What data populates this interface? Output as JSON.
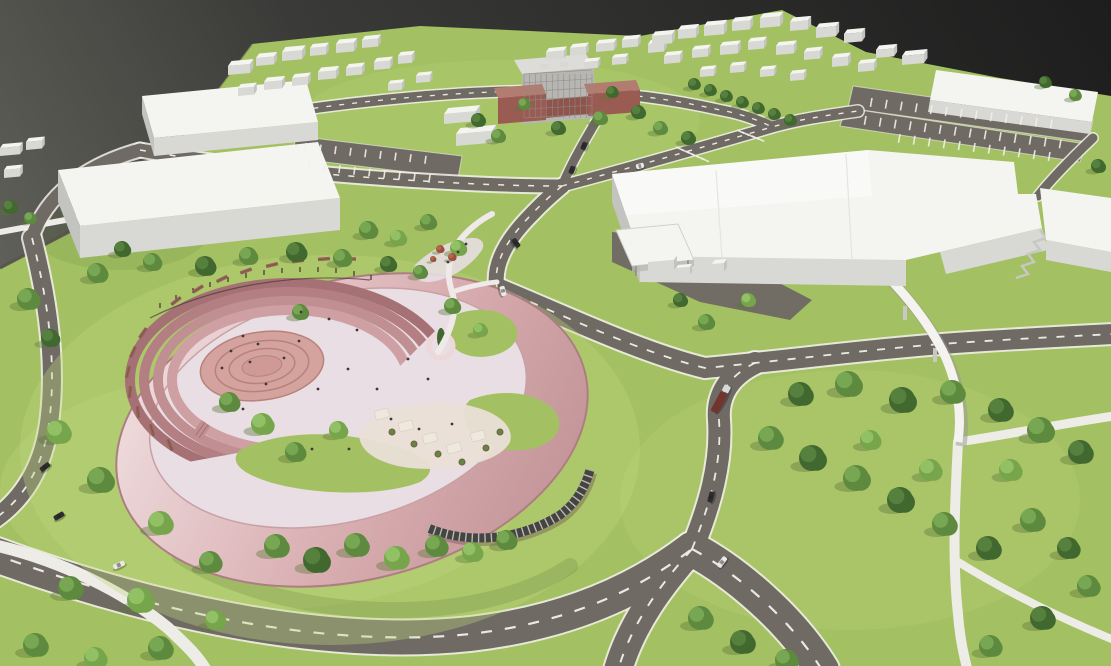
{
  "scene_label": "aerial-3d-masterplan-render",
  "palette": {
    "backdrop_top": "#1d1d1d",
    "backdrop_mid": "#3a3a38",
    "backdrop_low": "#75756c",
    "grass": "#a3c162",
    "grass_light": "#c0d77f",
    "grass_dark": "#86a84e",
    "shadow_green": "#5d763a",
    "road": "#6f6a64",
    "marking": "#f2f0ea",
    "path": "#edece6",
    "bridge": "#f4f3ef",
    "bridge_shadow": "#9a9993",
    "bld_top": "#f4f4f1",
    "bld_top2": "#fbfbf9",
    "bld_front": "#d8d8d4",
    "bld_side": "#c3c3bf",
    "brick": "#9a5c52",
    "brick_top": "#b27c70",
    "brick_dark": "#8f544b",
    "midrise_face": "#b8b6b2",
    "midrise_top": "#dcdcd8",
    "window": "#8e8c88",
    "rose_light": "#ecd7d9",
    "rose": "#d9aeb1",
    "rose_deep": "#c4969a",
    "rose_edge": "#ad7e81",
    "terrace1": "#cfa0a3",
    "terrace2": "#c08f92",
    "terrace3": "#b37f83",
    "terrace4": "#a67174",
    "plaza": "#d5a39e",
    "plaza_ring": "#b8817c",
    "plaza_core": "#cf9a95",
    "paving": "#e8dee3",
    "paving_warm": "#eadfd6",
    "glass": "#454442",
    "mullion": "#cfcfcb",
    "bench": "#96655a",
    "post": "#4a3a36",
    "tree_dark": "#41682f",
    "tree_dark_hi": "#5a8540",
    "tree_mid": "#5d8a3e",
    "tree_mid_hi": "#7cab57",
    "tree_light": "#76a54b",
    "tree_light_hi": "#97c46a",
    "shrub": "#9c4f3d",
    "shrub_hi": "#bc6a4e",
    "car_dark": "#2e2e30",
    "car_gray": "#55565a",
    "car_white": "#e8e8e6",
    "truck_body": "#70352f",
    "truck_cab": "#d8d8d6",
    "people": "#3a3a3c",
    "canopy_shade": "#efe9dd",
    "planter_rim": "#7a5c49"
  },
  "scene": {
    "trees": [
      [
        28,
        299,
        11,
        "m"
      ],
      [
        50,
        338,
        9,
        "d"
      ],
      [
        10,
        207,
        7,
        "d"
      ],
      [
        30,
        218,
        6,
        "m"
      ],
      [
        97,
        273,
        10,
        "m"
      ],
      [
        122,
        249,
        8,
        "d"
      ],
      [
        152,
        262,
        9,
        "m"
      ],
      [
        205,
        266,
        10,
        "d"
      ],
      [
        248,
        256,
        9,
        "m"
      ],
      [
        296,
        252,
        10,
        "d"
      ],
      [
        342,
        258,
        9,
        "m"
      ],
      [
        388,
        264,
        8,
        "d"
      ],
      [
        58,
        432,
        12,
        "l"
      ],
      [
        100,
        480,
        13,
        "m"
      ],
      [
        160,
        523,
        12,
        "l"
      ],
      [
        210,
        562,
        11,
        "m"
      ],
      [
        140,
        600,
        13,
        "l"
      ],
      [
        70,
        588,
        12,
        "m"
      ],
      [
        35,
        645,
        12,
        "m"
      ],
      [
        95,
        658,
        11,
        "l"
      ],
      [
        160,
        648,
        12,
        "m"
      ],
      [
        215,
        620,
        10,
        "l"
      ],
      [
        229,
        402,
        10,
        "m"
      ],
      [
        262,
        424,
        11,
        "l"
      ],
      [
        295,
        452,
        10,
        "m"
      ],
      [
        338,
        430,
        9,
        "l"
      ],
      [
        300,
        312,
        8,
        "m"
      ],
      [
        452,
        306,
        8,
        "m"
      ],
      [
        480,
        330,
        7,
        "l"
      ],
      [
        276,
        546,
        12,
        "m"
      ],
      [
        316,
        560,
        13,
        "d"
      ],
      [
        356,
        545,
        12,
        "m"
      ],
      [
        396,
        558,
        12,
        "l"
      ],
      [
        436,
        546,
        11,
        "m"
      ],
      [
        472,
        552,
        10,
        "l"
      ],
      [
        506,
        540,
        10,
        "m"
      ],
      [
        368,
        230,
        9,
        "m"
      ],
      [
        398,
        238,
        8,
        "l"
      ],
      [
        428,
        222,
        8,
        "m"
      ],
      [
        458,
        248,
        8,
        "l"
      ],
      [
        420,
        272,
        7,
        "m"
      ],
      [
        440,
        249,
        4,
        "r"
      ],
      [
        452,
        257,
        4,
        "r"
      ],
      [
        433,
        259,
        3,
        "r"
      ],
      [
        478,
        120,
        7,
        "d"
      ],
      [
        498,
        136,
        7,
        "m"
      ],
      [
        558,
        128,
        7,
        "d"
      ],
      [
        600,
        118,
        7,
        "m"
      ],
      [
        638,
        112,
        7,
        "d"
      ],
      [
        660,
        128,
        7,
        "m"
      ],
      [
        612,
        92,
        6,
        "d"
      ],
      [
        524,
        104,
        6,
        "m"
      ],
      [
        688,
        138,
        7,
        "d"
      ],
      [
        694,
        84,
        6,
        "d"
      ],
      [
        710,
        90,
        6,
        "d"
      ],
      [
        726,
        96,
        6,
        "d"
      ],
      [
        742,
        102,
        6,
        "d"
      ],
      [
        758,
        108,
        6,
        "d"
      ],
      [
        774,
        114,
        6,
        "d"
      ],
      [
        790,
        120,
        6,
        "d"
      ],
      [
        800,
        394,
        12,
        "d"
      ],
      [
        848,
        384,
        13,
        "m"
      ],
      [
        902,
        400,
        13,
        "d"
      ],
      [
        952,
        392,
        12,
        "m"
      ],
      [
        1000,
        410,
        12,
        "d"
      ],
      [
        1040,
        430,
        13,
        "m"
      ],
      [
        1080,
        452,
        12,
        "d"
      ],
      [
        770,
        438,
        12,
        "m"
      ],
      [
        812,
        458,
        13,
        "d"
      ],
      [
        856,
        478,
        13,
        "m"
      ],
      [
        900,
        500,
        13,
        "d"
      ],
      [
        944,
        524,
        12,
        "m"
      ],
      [
        988,
        548,
        12,
        "d"
      ],
      [
        1032,
        520,
        12,
        "m"
      ],
      [
        1068,
        548,
        11,
        "d"
      ],
      [
        930,
        470,
        11,
        "l"
      ],
      [
        870,
        440,
        10,
        "l"
      ],
      [
        1010,
        470,
        11,
        "l"
      ],
      [
        700,
        618,
        12,
        "m"
      ],
      [
        742,
        642,
        12,
        "d"
      ],
      [
        786,
        660,
        11,
        "m"
      ],
      [
        990,
        646,
        11,
        "m"
      ],
      [
        1042,
        618,
        12,
        "d"
      ],
      [
        1088,
        586,
        11,
        "m"
      ],
      [
        706,
        322,
        8,
        "m"
      ],
      [
        748,
        300,
        7,
        "l"
      ],
      [
        680,
        300,
        7,
        "d"
      ],
      [
        1045,
        82,
        6,
        "d"
      ],
      [
        1075,
        95,
        6,
        "m"
      ],
      [
        1098,
        166,
        7,
        "d"
      ]
    ],
    "blocks": [
      [
        228,
        66,
        22,
        10,
        9
      ],
      [
        256,
        58,
        18,
        9,
        8
      ],
      [
        282,
        52,
        20,
        10,
        9
      ],
      [
        310,
        48,
        16,
        8,
        8
      ],
      [
        336,
        44,
        18,
        9,
        9
      ],
      [
        362,
        40,
        16,
        8,
        8
      ],
      [
        238,
        88,
        16,
        8,
        8
      ],
      [
        264,
        82,
        18,
        9,
        8
      ],
      [
        292,
        78,
        16,
        8,
        8
      ],
      [
        318,
        72,
        18,
        9,
        8
      ],
      [
        346,
        68,
        16,
        8,
        8
      ],
      [
        374,
        62,
        16,
        8,
        8
      ],
      [
        398,
        56,
        14,
        8,
        8
      ],
      [
        388,
        84,
        14,
        7,
        7
      ],
      [
        416,
        76,
        14,
        7,
        7
      ],
      [
        546,
        52,
        18,
        8,
        8
      ],
      [
        570,
        48,
        16,
        8,
        8
      ],
      [
        596,
        44,
        18,
        8,
        8
      ],
      [
        622,
        40,
        16,
        8,
        8
      ],
      [
        648,
        44,
        16,
        8,
        9
      ],
      [
        584,
        62,
        14,
        7,
        7
      ],
      [
        612,
        58,
        14,
        7,
        7
      ],
      [
        652,
        36,
        20,
        9,
        9
      ],
      [
        678,
        30,
        18,
        9,
        9
      ],
      [
        704,
        26,
        20,
        9,
        10
      ],
      [
        732,
        22,
        18,
        9,
        9
      ],
      [
        760,
        18,
        20,
        9,
        10
      ],
      [
        790,
        22,
        18,
        9,
        9
      ],
      [
        816,
        28,
        20,
        9,
        10
      ],
      [
        844,
        34,
        18,
        9,
        9
      ],
      [
        664,
        56,
        16,
        8,
        8
      ],
      [
        692,
        50,
        16,
        8,
        8
      ],
      [
        720,
        46,
        18,
        8,
        9
      ],
      [
        748,
        42,
        16,
        8,
        8
      ],
      [
        776,
        46,
        18,
        8,
        9
      ],
      [
        804,
        52,
        16,
        8,
        8
      ],
      [
        832,
        58,
        16,
        8,
        9
      ],
      [
        858,
        64,
        16,
        8,
        8
      ],
      [
        700,
        70,
        14,
        7,
        7
      ],
      [
        730,
        66,
        14,
        7,
        7
      ],
      [
        760,
        70,
        14,
        7,
        7
      ],
      [
        790,
        74,
        14,
        7,
        7
      ],
      [
        0,
        148,
        20,
        8,
        8
      ],
      [
        26,
        142,
        16,
        8,
        8
      ],
      [
        4,
        170,
        16,
        8,
        8
      ],
      [
        444,
        114,
        32,
        12,
        10
      ],
      [
        456,
        134,
        36,
        12,
        12
      ],
      [
        902,
        56,
        22,
        10,
        9
      ],
      [
        876,
        50,
        18,
        9,
        8
      ],
      [
        648,
        262,
        26,
        8,
        10
      ],
      [
        676,
        268,
        14,
        6,
        8
      ],
      [
        712,
        264,
        12,
        8,
        9
      ]
    ],
    "cars": [
      [
        45,
        467,
        -38,
        11,
        "k"
      ],
      [
        59,
        516,
        -30,
        11,
        "k"
      ],
      [
        119,
        565,
        -24,
        12,
        "w"
      ],
      [
        516,
        243,
        55,
        10,
        "k"
      ],
      [
        503,
        291,
        75,
        10,
        "w"
      ],
      [
        711,
        497,
        -75,
        11,
        "k"
      ],
      [
        722,
        562,
        -52,
        12,
        "w"
      ],
      [
        584,
        146,
        -68,
        8,
        "k"
      ],
      [
        572,
        170,
        -68,
        8,
        "k"
      ],
      [
        640,
        166,
        -15,
        8,
        "w"
      ]
    ],
    "truck": {
      "x": 721,
      "y": 399,
      "rot": -62
    },
    "people": [
      [
        231,
        351
      ],
      [
        243,
        336
      ],
      [
        258,
        344
      ],
      [
        284,
        358
      ],
      [
        299,
        341
      ],
      [
        266,
        384
      ],
      [
        318,
        389
      ],
      [
        348,
        369
      ],
      [
        377,
        389
      ],
      [
        301,
        312
      ],
      [
        329,
        319
      ],
      [
        357,
        330
      ],
      [
        408,
        359
      ],
      [
        428,
        379
      ],
      [
        391,
        419
      ],
      [
        419,
        429
      ],
      [
        452,
        424
      ],
      [
        349,
        449
      ],
      [
        312,
        449
      ],
      [
        243,
        409
      ],
      [
        222,
        368
      ],
      [
        250,
        362
      ],
      [
        458,
        252
      ],
      [
        466,
        244
      ],
      [
        448,
        262
      ]
    ],
    "posts": [
      [
        160,
        308
      ],
      [
        176,
        300
      ],
      [
        193,
        293
      ],
      [
        210,
        287
      ],
      [
        228,
        282
      ],
      [
        246,
        278
      ],
      [
        264,
        275
      ],
      [
        282,
        273
      ],
      [
        300,
        272
      ],
      [
        318,
        272
      ],
      [
        336,
        273
      ],
      [
        354,
        276
      ],
      [
        371,
        280
      ]
    ],
    "benches": [
      [
        176,
        301,
        -38
      ],
      [
        198,
        289,
        -32
      ],
      [
        222,
        279,
        -26
      ],
      [
        246,
        271,
        -20
      ],
      [
        272,
        265,
        -14
      ],
      [
        298,
        261,
        -8
      ],
      [
        324,
        259,
        -4
      ],
      [
        350,
        259,
        0
      ],
      [
        143,
        333,
        -55
      ],
      [
        133,
        352,
        -65
      ],
      [
        128,
        372,
        -75
      ],
      [
        130,
        392,
        -85
      ],
      [
        138,
        412,
        -95
      ],
      [
        152,
        430,
        -105
      ],
      [
        170,
        445,
        -112
      ]
    ],
    "stall_rows": [
      {
        "x": 872,
        "y": 98,
        "n": 13,
        "dx": 15,
        "dy": 1.8,
        "len": 9,
        "rot": 100
      },
      {
        "x": 866,
        "y": 116,
        "n": 14,
        "dx": 15,
        "dy": 1.8,
        "len": 9,
        "rot": 100
      },
      {
        "x": 900,
        "y": 134,
        "n": 11,
        "dx": 15,
        "dy": 1.8,
        "len": 9,
        "rot": 100
      },
      {
        "x": 306,
        "y": 143,
        "n": 9,
        "dx": 15,
        "dy": 1.6,
        "len": 8,
        "rot": 98
      },
      {
        "x": 310,
        "y": 162,
        "n": 9,
        "dx": 15,
        "dy": 1.6,
        "len": 8,
        "rot": 98
      },
      {
        "x": 676,
        "y": 147,
        "n": 6,
        "dx": 5,
        "dy": 2.2,
        "len": 9,
        "rot": 25
      },
      {
        "x": 737,
        "y": 130,
        "n": 5,
        "dx": 5,
        "dy": 2,
        "len": 8,
        "rot": 25
      }
    ],
    "grids": [
      {
        "x": 524,
        "y": 74,
        "w": 68,
        "h": 44,
        "cols": 12,
        "rows": 5
      }
    ],
    "canopies": [
      [
        382,
        414
      ],
      [
        406,
        426
      ],
      [
        430,
        438
      ],
      [
        454,
        448
      ],
      [
        478,
        436
      ]
    ],
    "planters": [
      [
        392,
        432
      ],
      [
        414,
        444
      ],
      [
        438,
        454
      ],
      [
        462,
        462
      ],
      [
        486,
        448
      ],
      [
        500,
        432
      ]
    ]
  }
}
